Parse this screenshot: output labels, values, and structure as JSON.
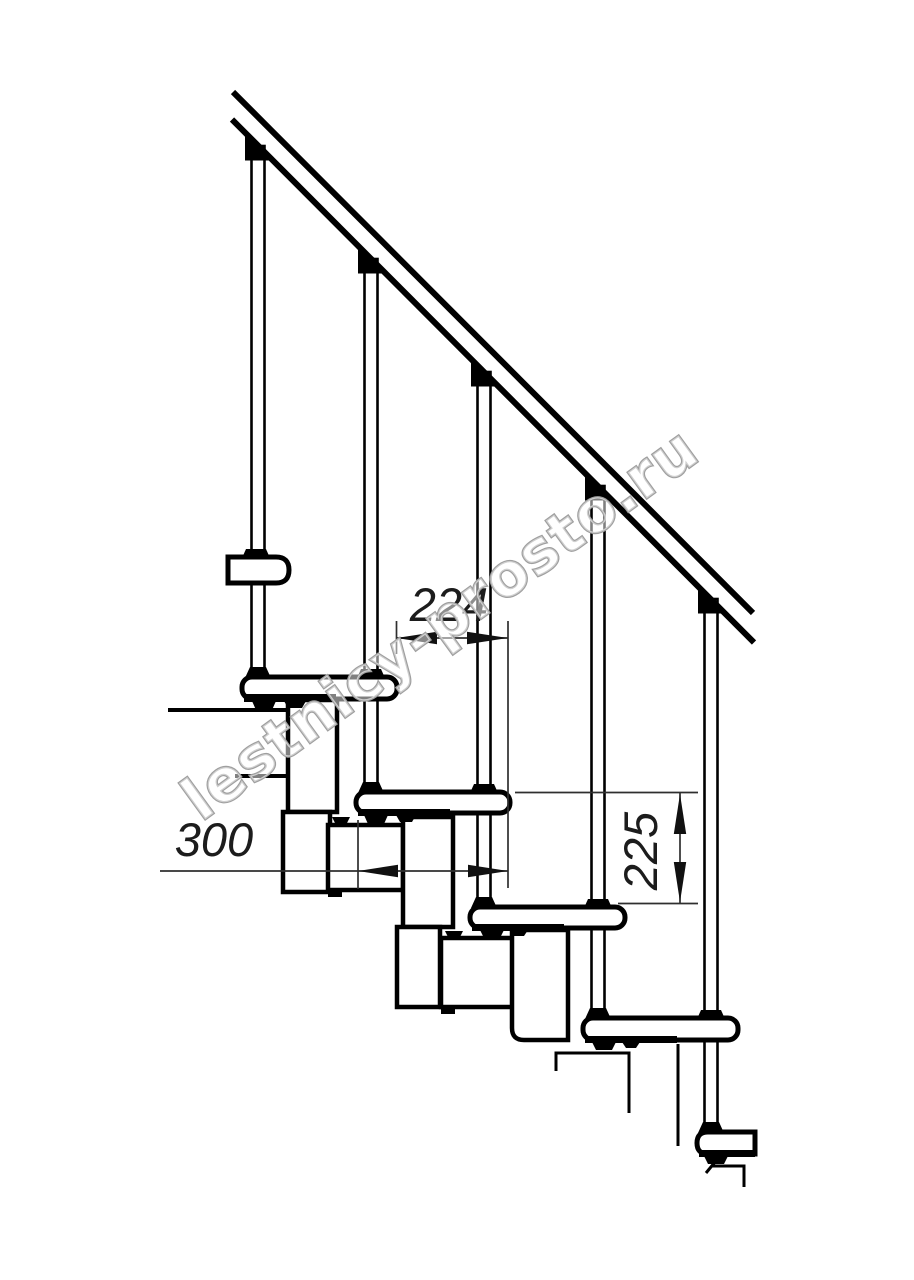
{
  "drawing": {
    "kind": "staircase-side-elevation-line-drawing",
    "background": "#ffffff",
    "line_color": "#000000",
    "dimension_line_color": "#2f2f2f",
    "structure": {
      "handrail": true,
      "balusters_count": 5,
      "treads_visible": 6,
      "support_modules": "zigzag chain of square modules under treads"
    },
    "dimensions": {
      "going": {
        "value": "224",
        "orientation": "horizontal"
      },
      "depth": {
        "value": "300",
        "orientation": "horizontal"
      },
      "rise": {
        "value": "225",
        "orientation": "vertical"
      }
    }
  },
  "watermark": {
    "text": "lestnicy-prosto.ru",
    "color": "#9f9f9f"
  }
}
